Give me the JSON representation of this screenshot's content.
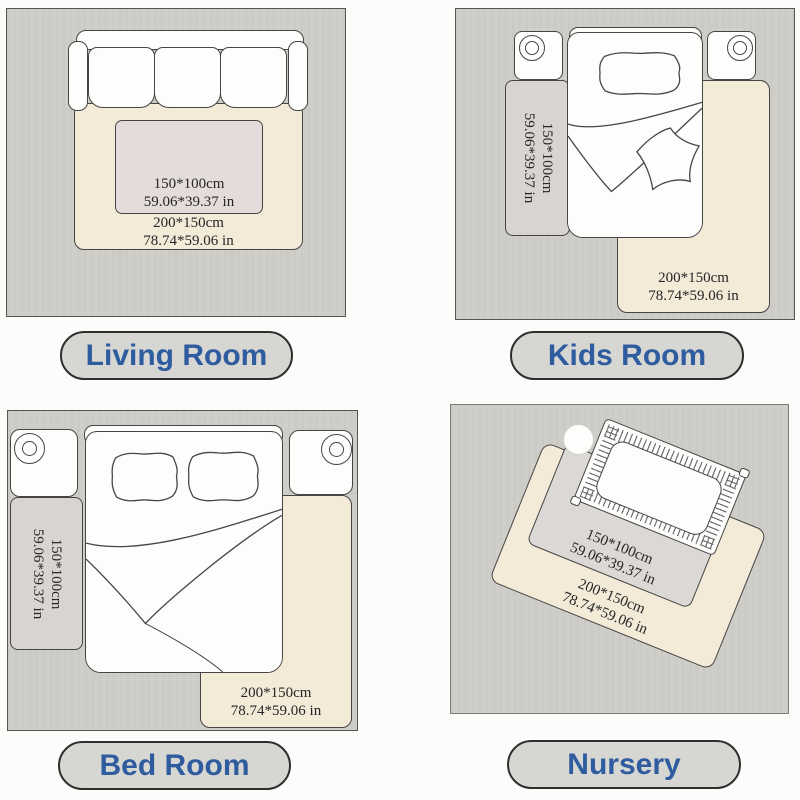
{
  "palette": {
    "page_bg": "#fcfcfa",
    "floor": "#cecdc8",
    "floor_border": "#55554f",
    "outline": "#454545",
    "furniture_white": "#fdfdfb",
    "rug_beige": "#f3ead8",
    "rug_gray": "#d8d4d1",
    "rug_gray_light": "#e3dcda",
    "rug_gray_nursery": "#dcd8d5",
    "pill_bg": "#d6d6d3",
    "pill_border": "#2e2e2e",
    "label_blue": "#2e5c9e",
    "dim_text": "#262626",
    "slat_color": "#6f6f6f"
  },
  "rooms": {
    "living": {
      "label": "Living Room",
      "rug_small": {
        "cm": "150*100cm",
        "inches": "59.06*39.37 in"
      },
      "rug_large": {
        "cm": "200*150cm",
        "inches": "78.74*59.06 in"
      }
    },
    "kids": {
      "label": "Kids Room",
      "rug_small": {
        "cm": "150*100cm",
        "inches": "59.06*39.37 in"
      },
      "rug_large": {
        "cm": "200*150cm",
        "inches": "78.74*59.06 in"
      }
    },
    "bedroom": {
      "label": "Bed Room",
      "rug_small": {
        "cm": "150*100cm",
        "inches": "59.06*39.37 in"
      },
      "rug_large": {
        "cm": "200*150cm",
        "inches": "78.74*59.06 in"
      }
    },
    "nursery": {
      "label": "Nursery",
      "rug_small": {
        "cm": "150*100cm",
        "inches": "59.06*39.37 in"
      },
      "rug_large": {
        "cm": "200*150cm",
        "inches": "78.74*59.06 in"
      }
    }
  }
}
